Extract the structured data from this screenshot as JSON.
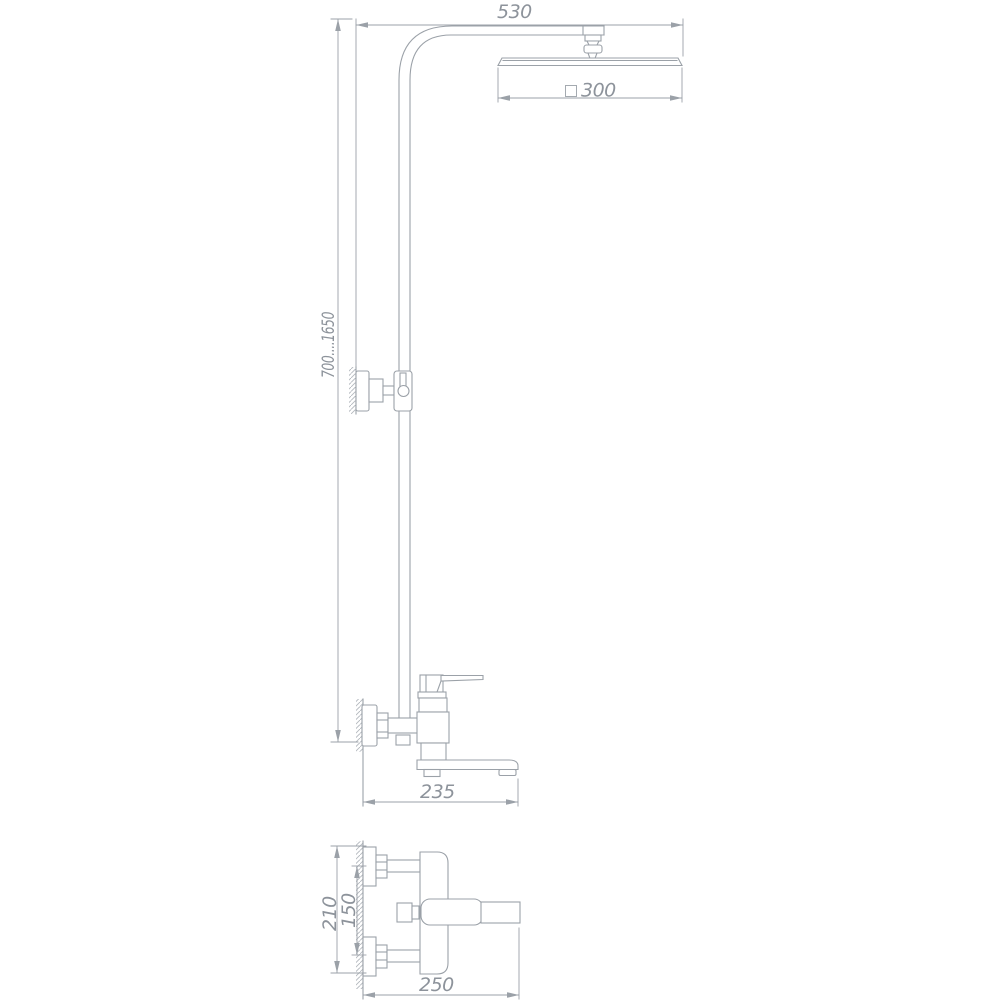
{
  "drawing": {
    "type": "shower-system-technical-drawing",
    "dimensions": {
      "arm_reach": "530",
      "head_size": "300",
      "column_height_range": "700....1650",
      "spout_length": "235",
      "front_height": "210",
      "connection_centers": "150",
      "front_length": "250"
    }
  }
}
